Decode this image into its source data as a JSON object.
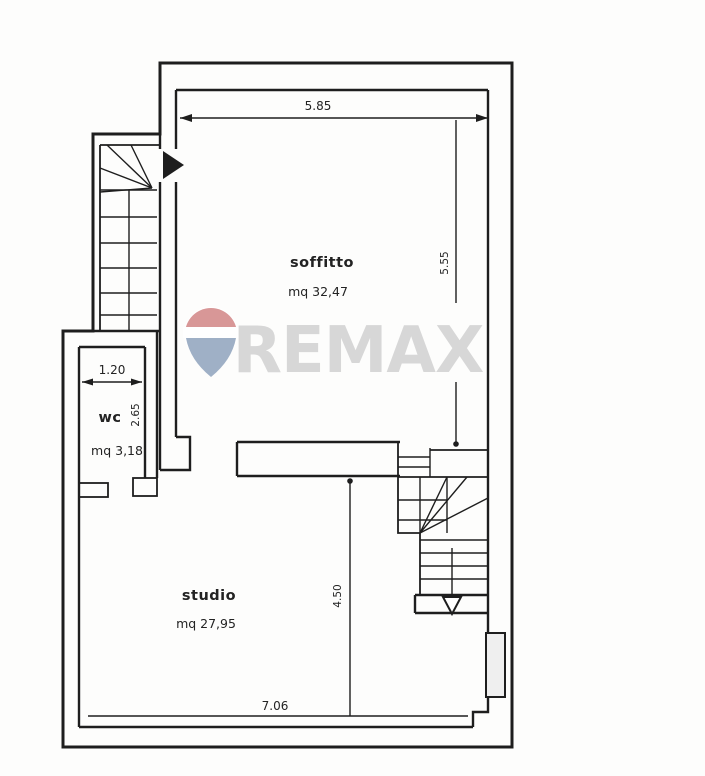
{
  "watermark": {
    "text": "REMAX",
    "text_color": "#d7d7d7",
    "balloon_red": "#d89797",
    "balloon_blue": "#9fb0c6"
  },
  "rooms": {
    "soffitto": {
      "name": "soffitto",
      "area": "mq 32,47"
    },
    "wc": {
      "name": "wc",
      "area": "mq 3,18"
    },
    "studio": {
      "name": "studio",
      "area": "mq 27,95"
    }
  },
  "dimensions": {
    "soffitto_width": "5.85",
    "soffitto_depth": "5.55",
    "wc_width": "1.20",
    "wc_depth": "2.65",
    "studio_depth": "4.50",
    "studio_width": "7.06"
  }
}
